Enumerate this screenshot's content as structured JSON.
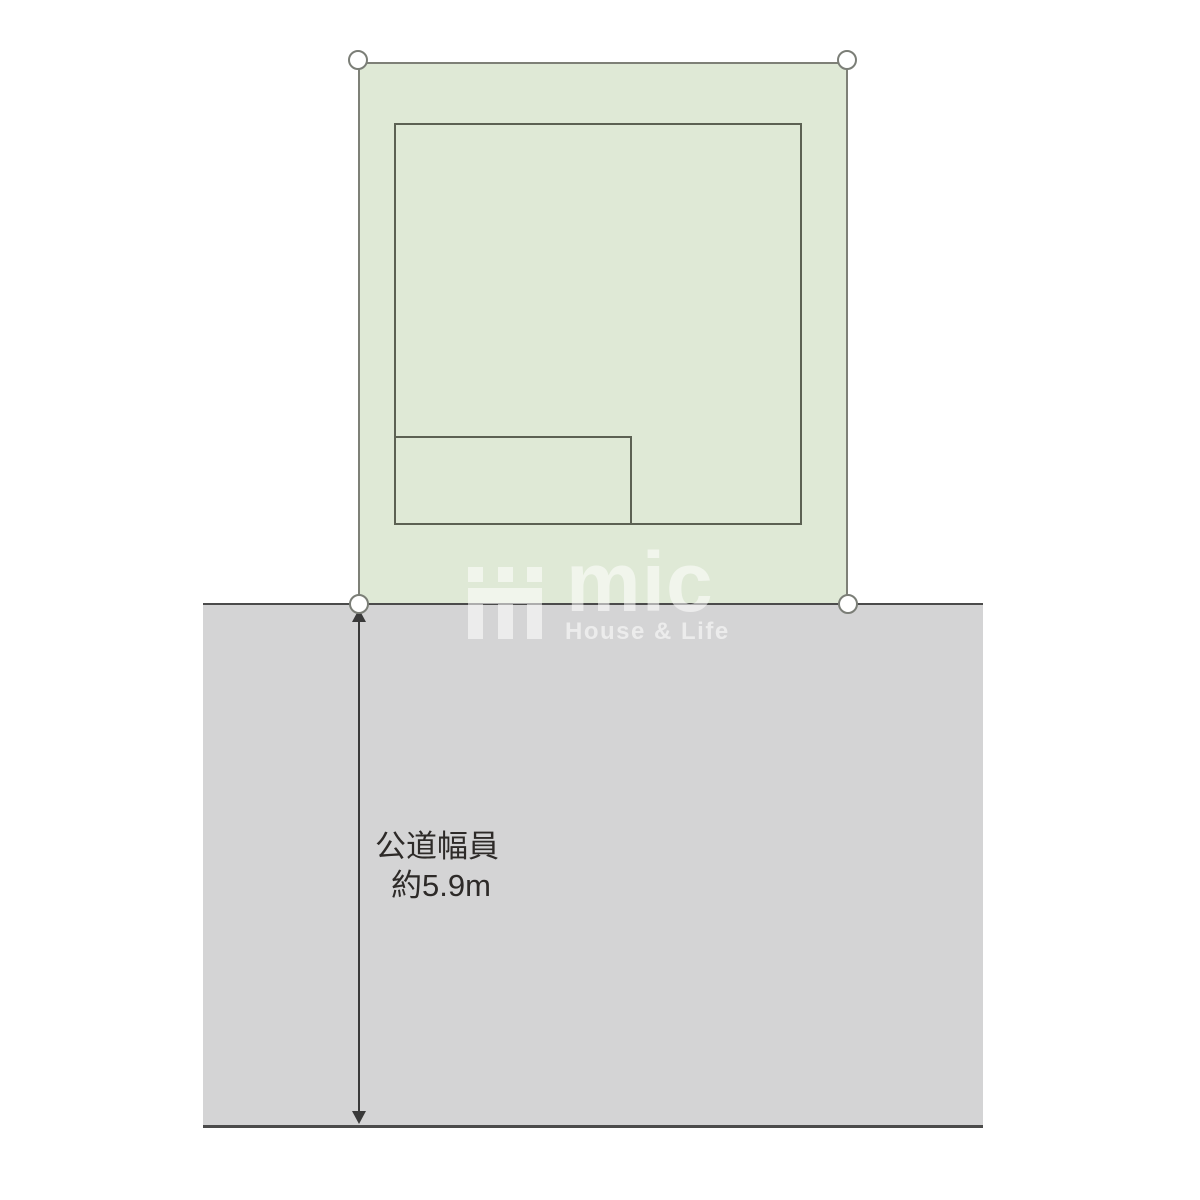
{
  "site_plan": {
    "lot": {
      "fill": "#dfe9d6",
      "border": "#7e8077"
    },
    "building": {
      "outline": "#5c6153"
    },
    "road": {
      "fill": "#d4d4d5",
      "border": "#4b4b4b",
      "width_label": {
        "line1": "公道幅員",
        "line2": "約5.9m"
      }
    },
    "boundary_markers": {
      "count": 4,
      "fill": "#ffffff",
      "stroke": "#7b7e77"
    },
    "dimension_arrow": {
      "color": "#3a3a3a",
      "direction": "vertical-double"
    },
    "label_color": "#2d2a28"
  },
  "watermark": {
    "brand": "mic",
    "tagline": "House & Life",
    "color": "#ffffff",
    "opacity": 0.55,
    "icon": "mic-triple-bar-icon"
  }
}
